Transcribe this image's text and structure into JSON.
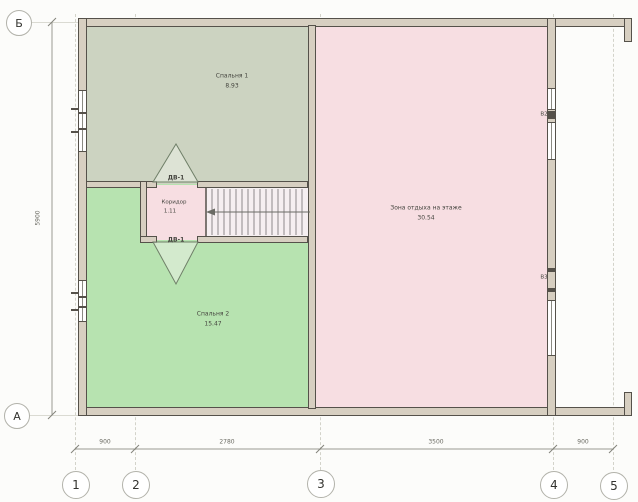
{
  "grid": {
    "rows": [
      "Б",
      "А"
    ],
    "cols": [
      "1",
      "2",
      "3",
      "4",
      "5"
    ]
  },
  "rooms": {
    "bedroom1": {
      "name": "Спальня 1",
      "area": "8.93"
    },
    "bedroom2": {
      "name": "Спальня 2",
      "area": "15.47"
    },
    "lounge": {
      "name": "Зона отдыха на этаже",
      "area": "30.54"
    },
    "corridor": {
      "name": "Коридор",
      "area": "1.11"
    }
  },
  "doors": {
    "top_label": "ДВ-1",
    "bottom_label": "ДВ-1"
  },
  "windows": {
    "right_upper_label": "В2",
    "right_lower_label": "В3"
  },
  "dimensions": {
    "bottom": [
      "900",
      "2780",
      "3500",
      "900"
    ],
    "left_total": "5900"
  },
  "colors": {
    "bedroom1_fill": "#ccd3c1",
    "bedroom2_fill": "#b7e3b0",
    "lounge_fill": "#f7dee2",
    "stair_fill": "#f6eff1",
    "wall_fill": "#d7cfc1",
    "wall_line": "#55514a"
  }
}
